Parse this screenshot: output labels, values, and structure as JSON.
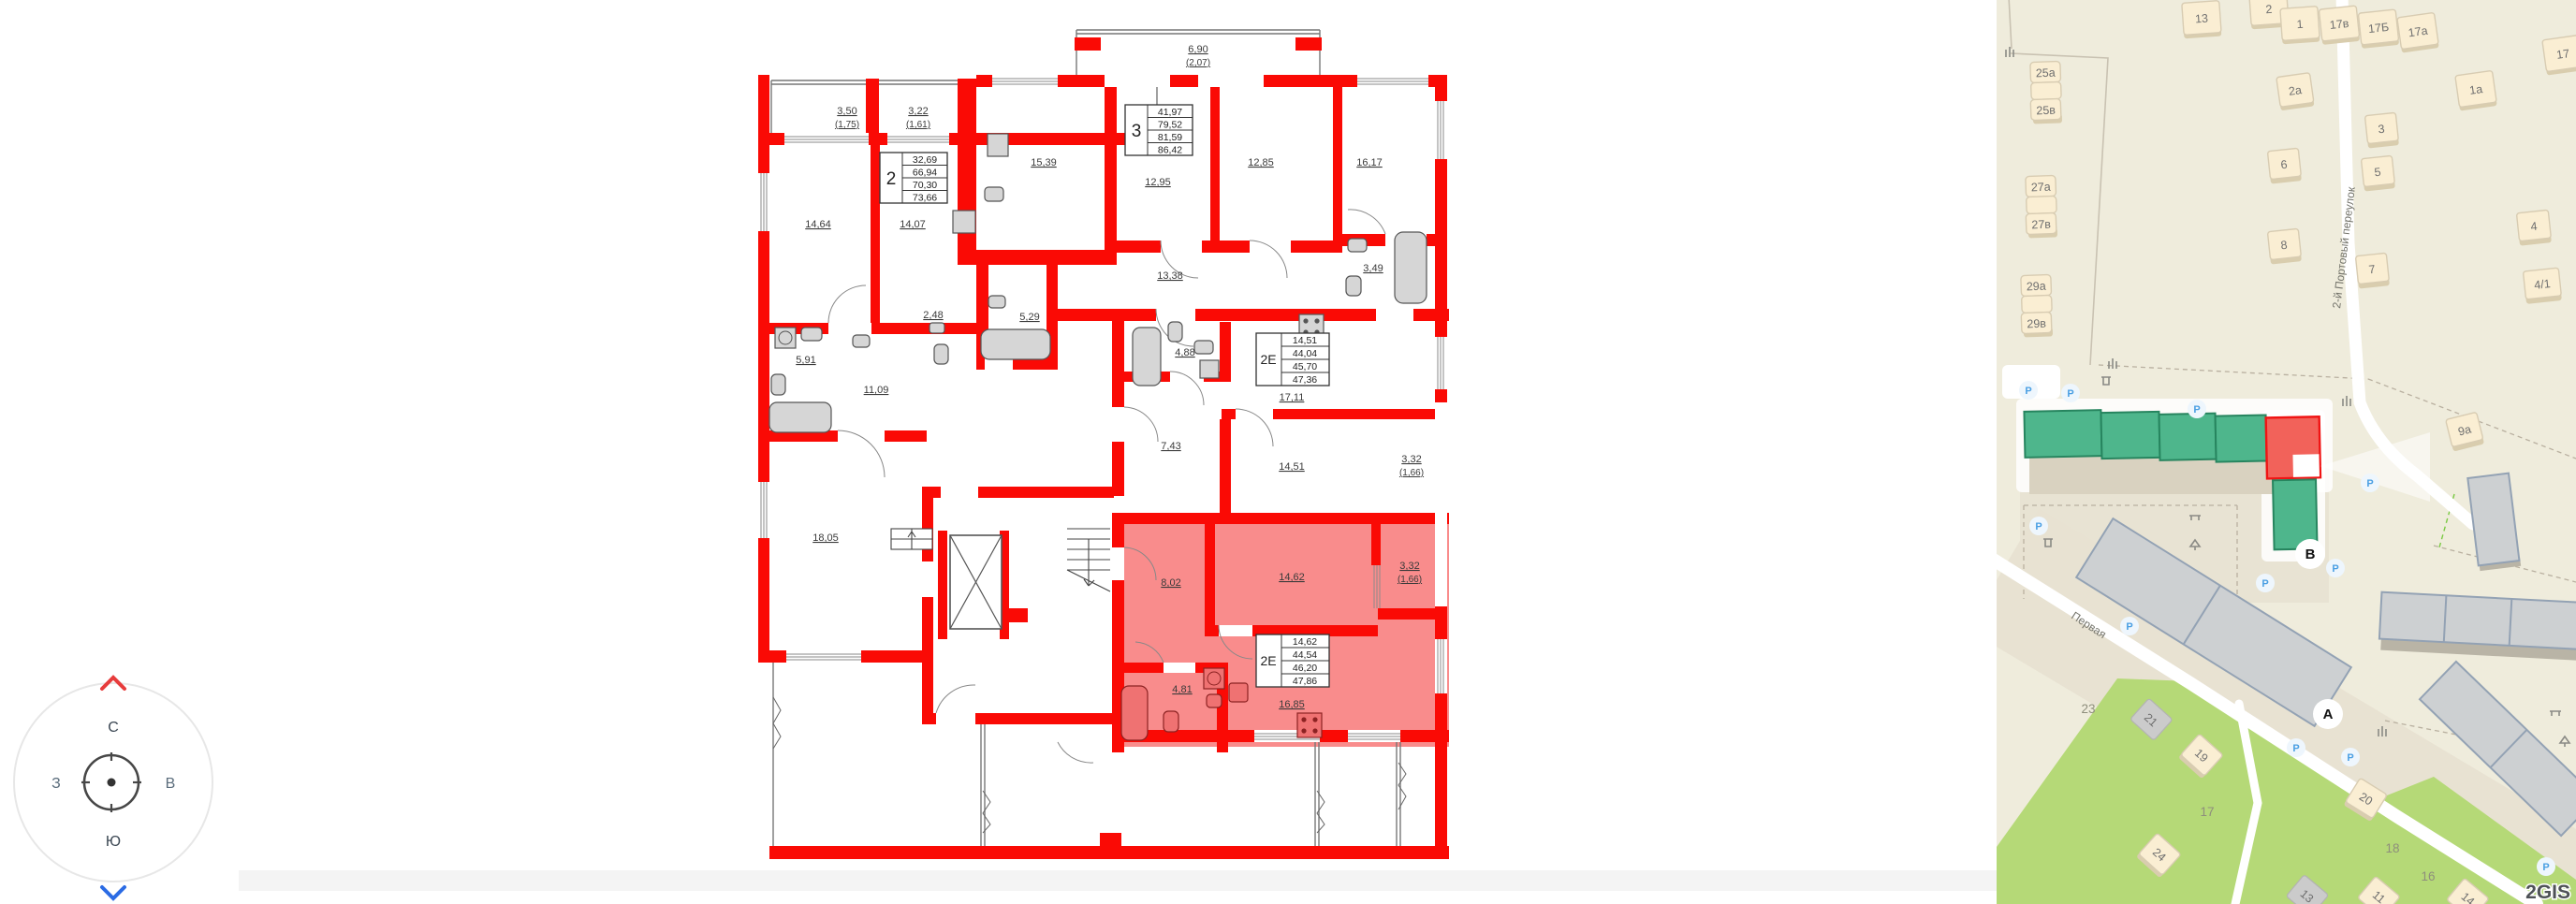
{
  "colors": {
    "wall_red": "#fa0a05",
    "highlight_pink": "#f98c8c",
    "map_building_green": "#4eb68c",
    "map_building_red": "#f2625a",
    "compass_north_arrow": "#e73c3c",
    "compass_south_arrow": "#2b6be4"
  },
  "compass": {
    "n": "С",
    "e": "В",
    "s": "Ю",
    "w": "З"
  },
  "plan": {
    "apartments": {
      "a2": {
        "t": "2",
        "r1": "32,69",
        "r2": "66,94",
        "r3": "70,30",
        "r4": "73,66"
      },
      "a3": {
        "t": "3",
        "r1": "41,97",
        "r2": "79,52",
        "r3": "81,59",
        "r4": "86,42"
      },
      "et": {
        "t": "2Е",
        "r1": "14,51",
        "r2": "44,04",
        "r3": "45,70",
        "r4": "47,36"
      },
      "es": {
        "t": "2Е",
        "r1": "14,62",
        "r2": "44,54",
        "r3": "46,20",
        "r4": "47,86"
      }
    },
    "rooms": {
      "balc350": "3,50",
      "balc350s": "(1,75)",
      "balc322": "3,22",
      "balc322s": "(1,61)",
      "r1464": "14,64",
      "r1407": "14,07",
      "r1539": "15,39",
      "balc690": "6,90",
      "balc690s": "(2,07)",
      "r1295": "12,95",
      "r1285": "12,85",
      "r1617": "16,17",
      "r1338": "13,38",
      "r349": "3,49",
      "r488": "4,88",
      "r1711": "17,11",
      "r743": "7,43",
      "r1451": "14,51",
      "balc332t": "3,32",
      "balc332ts": "(1,66)",
      "r591": "5,91",
      "r248": "2,48",
      "r1109": "11,09",
      "r529": "5,29",
      "r1805": "18,05",
      "r802": "8,02",
      "r1462": "14,62",
      "balc332b": "3,32",
      "balc332bs": "(1,66)",
      "r481": "4,81",
      "r1685": "16,85"
    }
  },
  "map": {
    "logo": "2GIS",
    "parking": "P",
    "streets": {
      "pervaya": "Первая",
      "portovy": "2-й Портовый переулок"
    },
    "markers": {
      "a": "А",
      "b": "В"
    },
    "buildings": {
      "b13": "13",
      "b2": "2",
      "b1": "1",
      "b17v": "17в",
      "b17b": "17Б",
      "b17a": "17а",
      "b17": "17",
      "b1a": "1а",
      "b2a": "2а",
      "b3": "3",
      "b5": "5",
      "b6": "6",
      "b7": "7",
      "b8": "8",
      "b4": "4",
      "b41": "4/1",
      "b9a": "9а",
      "b25a": "25а",
      "b25v": "25в",
      "b27a": "27а",
      "b27v": "27в",
      "b29a": "29а",
      "b29v": "29в",
      "b19": "19",
      "b20": "20",
      "b21": "21",
      "b24": "24",
      "b11": "11",
      "b13g": "13",
      "b14": "14"
    },
    "areas": {
      "t23": "23",
      "t17": "17",
      "t18": "18",
      "t16": "16"
    }
  }
}
